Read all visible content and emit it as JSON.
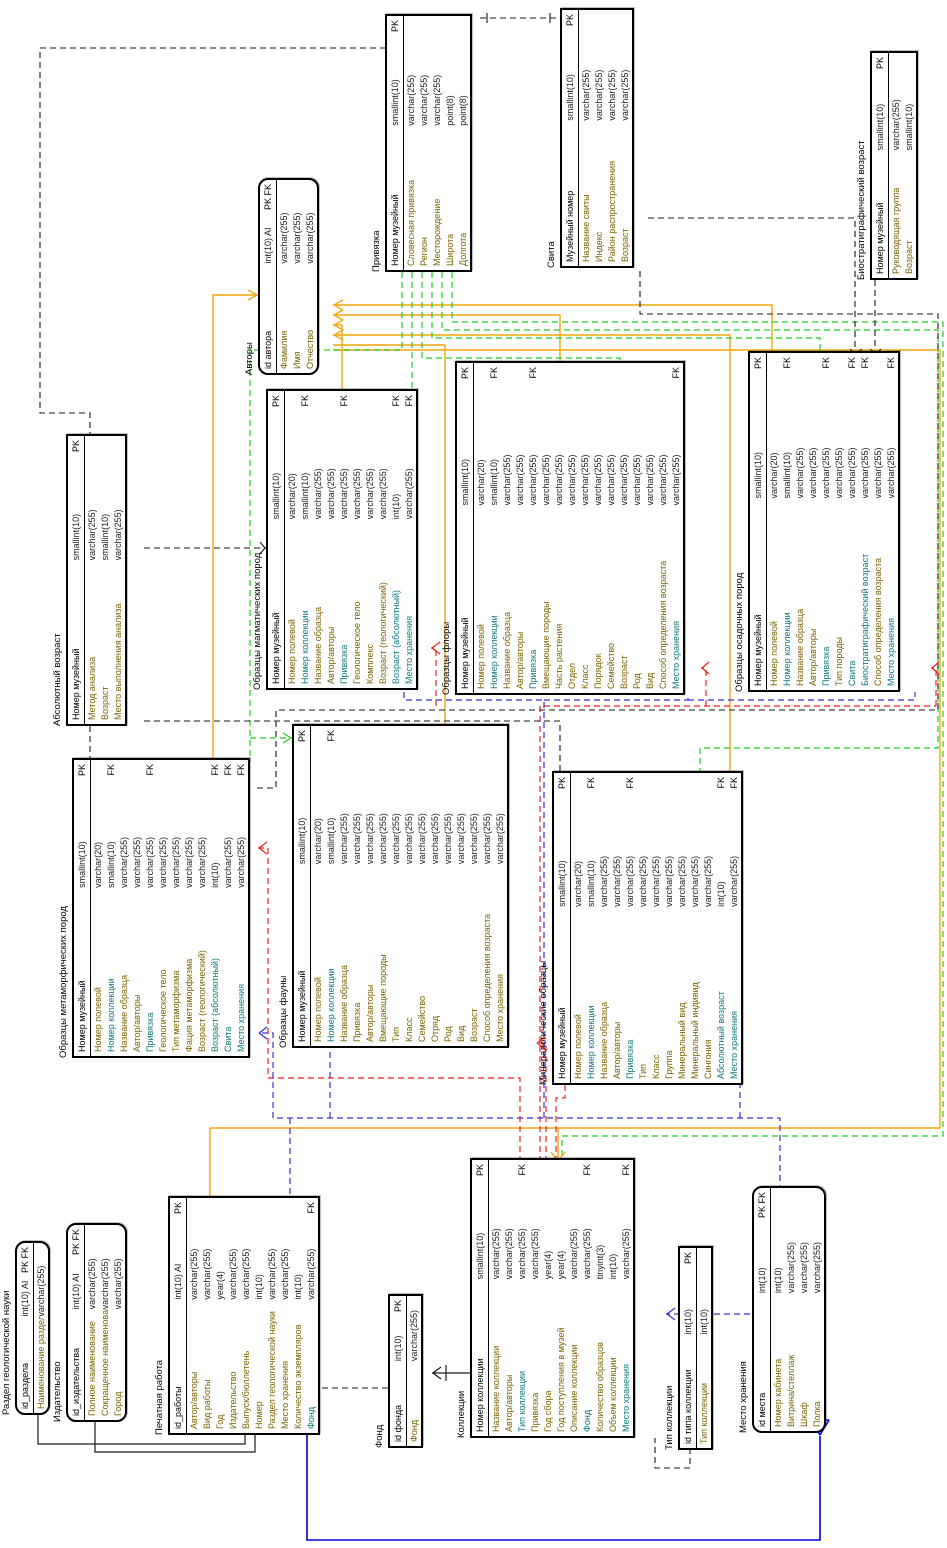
{
  "diagram": {
    "title": "EER-диаграмма геологического музея",
    "canvas": {
      "width": 1548,
      "height": 947,
      "rotation_deg": -90
    },
    "colors": {
      "authors_link": "#f2a70c",
      "privyazka_link": "#21cc21",
      "collection_link": "#ee2222",
      "storage_link_dashed": "#3333cc",
      "storage_link_solid": "#0000dd",
      "generic_link": "#1a1a1a",
      "fk_field_text": "#0e7878",
      "field_text": "#7a6400"
    },
    "tables": [
      {
        "id": "privyazka",
        "name": "Привязка",
        "x": 1276,
        "y": 385,
        "w": 254,
        "rounded": false,
        "fields": [
          {
            "n": "Номер музейный",
            "t": "smallint(10)",
            "k": "PK"
          },
          {
            "n": "Словесная привязка",
            "t": "varchar(255)",
            "k": ""
          },
          {
            "n": "Регион",
            "t": "varchar(255)",
            "k": ""
          },
          {
            "n": "Месторождение",
            "t": "varchar(255)",
            "k": ""
          },
          {
            "n": "Широта",
            "t": "point(8)",
            "k": ""
          },
          {
            "n": "Долгота",
            "t": "point(8)",
            "k": ""
          }
        ]
      },
      {
        "id": "svita",
        "name": "Свита",
        "x": 1280,
        "y": 560,
        "w": 256,
        "rounded": false,
        "fields": [
          {
            "n": "Музейный номер",
            "t": "smallint(10)",
            "k": "PK"
          },
          {
            "n": "Название свиты",
            "t": "varchar(255)",
            "k": ""
          },
          {
            "n": "Индекс",
            "t": "varchar(255)",
            "k": ""
          },
          {
            "n": "Район распространения",
            "t": "varchar(255)",
            "k": ""
          },
          {
            "n": "Возраст",
            "t": "varchar(255)",
            "k": ""
          }
        ]
      },
      {
        "id": "biostrat",
        "name": "Биостратиграфический возраст",
        "x": 1268,
        "y": 870,
        "w": 225,
        "rounded": false,
        "fields": [
          {
            "n": "Номер музейный",
            "t": "smallint(10)",
            "k": "PK"
          },
          {
            "n": "Руководящая группа",
            "t": "varchar(255)",
            "k": ""
          },
          {
            "n": "Возраст",
            "t": "smallint(10)",
            "k": ""
          }
        ]
      },
      {
        "id": "avtory",
        "name": "Авторы",
        "x": 1173,
        "y": 258,
        "w": 193,
        "rounded": true,
        "fields": [
          {
            "n": "id автора",
            "t": "int(10) AI",
            "k": "PK FK"
          },
          {
            "n": "Фамилия",
            "t": "varchar(255)",
            "k": ""
          },
          {
            "n": "Имя",
            "t": "varchar(255)",
            "k": ""
          },
          {
            "n": "Отчество",
            "t": "varchar(255)",
            "k": ""
          }
        ]
      },
      {
        "id": "abs_vozrast",
        "name": "Абсолютный возраст",
        "x": 822,
        "y": 66,
        "w": 288,
        "rounded": false,
        "fields": [
          {
            "n": "Номер музейный",
            "t": "smallint(10)",
            "k": "PK"
          },
          {
            "n": "Метод анализа",
            "t": "varchar(255)",
            "k": ""
          },
          {
            "n": "Возраст",
            "t": "smallint(10)",
            "k": ""
          },
          {
            "n": "Место выполнения анализа",
            "t": "varchar(255)",
            "k": ""
          }
        ]
      },
      {
        "id": "metamorf",
        "name": "Образцы метаморфических пород",
        "x": 490,
        "y": 72,
        "w": 296,
        "rounded": false,
        "fields": [
          {
            "n": "Номер музейный",
            "t": "smallint(10)",
            "k": "PK"
          },
          {
            "n": "Номер полевой",
            "t": "varchar(20)",
            "k": ""
          },
          {
            "n": "Номер коллекции",
            "t": "smallint(10)",
            "k": "FK"
          },
          {
            "n": "Название образца",
            "t": "varchar(255)",
            "k": ""
          },
          {
            "n": "Автор/авторы",
            "t": "varchar(255)",
            "k": ""
          },
          {
            "n": "Привязка",
            "t": "varchar(255)",
            "k": "FK"
          },
          {
            "n": "Геологическое тело",
            "t": "varchar(255)",
            "k": ""
          },
          {
            "n": "Тип метаморфизма",
            "t": "varchar(255)",
            "k": ""
          },
          {
            "n": "Фация метаморфизма",
            "t": "varchar(255)",
            "k": ""
          },
          {
            "n": "Возраст (геологический)",
            "t": "varchar(255)",
            "k": ""
          },
          {
            "n": "Возраст (абсолютный)",
            "t": "int(10)",
            "k": "FK"
          },
          {
            "n": "Свита",
            "t": "varchar(255)",
            "k": "FK"
          },
          {
            "n": "Место хранения",
            "t": "varchar(255)",
            "k": "FK"
          }
        ]
      },
      {
        "id": "magma",
        "name": "Образцы магматических пород",
        "x": 858,
        "y": 266,
        "w": 297,
        "rounded": false,
        "fields": [
          {
            "n": "Номер музейный",
            "t": "smallint(10)",
            "k": "PK"
          },
          {
            "n": "Номер полевой",
            "t": "varchar(20)",
            "k": ""
          },
          {
            "n": "Номер коллекции",
            "t": "smallint(10)",
            "k": "FK"
          },
          {
            "n": "Название образца",
            "t": "varchar(255)",
            "k": ""
          },
          {
            "n": "Автор/авторы",
            "t": "varchar(255)",
            "k": ""
          },
          {
            "n": "Привязка",
            "t": "varchar(255)",
            "k": "FK"
          },
          {
            "n": "Геологическое тело",
            "t": "varchar(255)",
            "k": ""
          },
          {
            "n": "Комплекс",
            "t": "varchar(255)",
            "k": ""
          },
          {
            "n": "Возраст (геологический)",
            "t": "varchar(255)",
            "k": ""
          },
          {
            "n": "Возраст (абсолютный)",
            "t": "int(10)",
            "k": "FK"
          },
          {
            "n": "Место хранения",
            "t": "varchar(255)",
            "k": "FK"
          }
        ]
      },
      {
        "id": "flora",
        "name": "Образцы флоры",
        "x": 853,
        "y": 455,
        "w": 330,
        "rounded": false,
        "fields": [
          {
            "n": "Номер музейный",
            "t": "smallint(10)",
            "k": "PK"
          },
          {
            "n": "Номер полевой",
            "t": "varchar(20)",
            "k": ""
          },
          {
            "n": "Номер коллекции",
            "t": "smallint(10)",
            "k": "FK"
          },
          {
            "n": "Название образца",
            "t": "varchar(255)",
            "k": ""
          },
          {
            "n": "Автор/авторы",
            "t": "varchar(255)",
            "k": ""
          },
          {
            "n": "Привязка",
            "t": "varchar(255)",
            "k": "FK"
          },
          {
            "n": "Вмещающие породы",
            "t": "varchar(255)",
            "k": ""
          },
          {
            "n": "Часть растения",
            "t": "varchar(255)",
            "k": ""
          },
          {
            "n": "Отдел",
            "t": "varchar(255)",
            "k": ""
          },
          {
            "n": "Класс",
            "t": "varchar(255)",
            "k": ""
          },
          {
            "n": "Порядок",
            "t": "varchar(255)",
            "k": ""
          },
          {
            "n": "Семейство",
            "t": "varchar(255)",
            "k": ""
          },
          {
            "n": "Возраст",
            "t": "varchar(255)",
            "k": ""
          },
          {
            "n": "Род",
            "t": "varchar(255)",
            "k": ""
          },
          {
            "n": "Вид",
            "t": "varchar(255)",
            "k": ""
          },
          {
            "n": "Способ определения возраста",
            "t": "varchar(255)",
            "k": ""
          },
          {
            "n": "Место хранения",
            "t": "varchar(255)",
            "k": "FK"
          }
        ]
      },
      {
        "id": "fauna",
        "name": "Образцы фауны",
        "x": 500,
        "y": 292,
        "w": 320,
        "rounded": false,
        "fields": [
          {
            "n": "Номер музейный",
            "t": "smallint(10)",
            "k": "PK"
          },
          {
            "n": "Номер полевой",
            "t": "varchar(20)",
            "k": ""
          },
          {
            "n": "Номер коллекции",
            "t": "smallint(10)",
            "k": "FK"
          },
          {
            "n": "Название образца",
            "t": "varchar(255)",
            "k": ""
          },
          {
            "n": "Привязка",
            "t": "varchar(255)",
            "k": ""
          },
          {
            "n": "Автор/авторы",
            "t": "varchar(255)",
            "k": ""
          },
          {
            "n": "Вмещающие породы",
            "t": "varchar(255)",
            "k": ""
          },
          {
            "n": "Тип",
            "t": "varchar(255)",
            "k": ""
          },
          {
            "n": "Класс",
            "t": "varchar(255)",
            "k": ""
          },
          {
            "n": "Семейство",
            "t": "varchar(255)",
            "k": ""
          },
          {
            "n": "Отряд",
            "t": "varchar(255)",
            "k": ""
          },
          {
            "n": "Род",
            "t": "varchar(255)",
            "k": ""
          },
          {
            "n": "Вид",
            "t": "varchar(255)",
            "k": ""
          },
          {
            "n": "Возраст",
            "t": "varchar(255)",
            "k": ""
          },
          {
            "n": "Способ определения возраста",
            "t": "varchar(255)",
            "k": ""
          },
          {
            "n": "Место хранения",
            "t": "varchar(255)",
            "k": ""
          }
        ]
      },
      {
        "id": "osad",
        "name": "Образцы осадочных пород",
        "x": 856,
        "y": 748,
        "w": 337,
        "rounded": false,
        "fields": [
          {
            "n": "Номер музейный",
            "t": "smallint(10)",
            "k": "PK"
          },
          {
            "n": "Номер полевой",
            "t": "varchar(20)",
            "k": ""
          },
          {
            "n": "Номер коллекции",
            "t": "smallint(10)",
            "k": "FK"
          },
          {
            "n": "Название образца",
            "t": "varchar(255)",
            "k": ""
          },
          {
            "n": "Автор/авторы",
            "t": "varchar(255)",
            "k": ""
          },
          {
            "n": "Привязка",
            "t": "varchar(255)",
            "k": "FK"
          },
          {
            "n": "Тип породы",
            "t": "varchar(255)",
            "k": ""
          },
          {
            "n": "Свита",
            "t": "varchar(255)",
            "k": "FK"
          },
          {
            "n": "Биостратиграфический возраст",
            "t": "varchar(255)",
            "k": "FK"
          },
          {
            "n": "Способ определения возраста",
            "t": "varchar(255)",
            "k": ""
          },
          {
            "n": "Место хранения",
            "t": "varchar(255)",
            "k": "FK"
          }
        ]
      },
      {
        "id": "minera",
        "name": "Минералогические образцы",
        "x": 463,
        "y": 552,
        "w": 310,
        "rounded": false,
        "fields": [
          {
            "n": "Номер музейный",
            "t": "smallint(10)",
            "k": "PK"
          },
          {
            "n": "Номер полевой",
            "t": "varchar(20)",
            "k": ""
          },
          {
            "n": "Номер коллекции",
            "t": "smallint(10)",
            "k": "FK"
          },
          {
            "n": "Название образца",
            "t": "varchar(255)",
            "k": ""
          },
          {
            "n": "Автор/авторы",
            "t": "varchar(255)",
            "k": ""
          },
          {
            "n": "Привязка",
            "t": "varchar(255)",
            "k": "FK"
          },
          {
            "n": "Тип",
            "t": "varchar(255)",
            "k": ""
          },
          {
            "n": "Класс",
            "t": "varchar(255)",
            "k": ""
          },
          {
            "n": "Группа",
            "t": "varchar(255)",
            "k": ""
          },
          {
            "n": "Минеральный вид",
            "t": "varchar(255)",
            "k": ""
          },
          {
            "n": "Минеральный индивид",
            "t": "varchar(255)",
            "k": ""
          },
          {
            "n": "Сингония",
            "t": "varchar(255)",
            "k": ""
          },
          {
            "n": "Абсолютный возраст",
            "t": "int(10)",
            "k": "FK"
          },
          {
            "n": "Место хранения",
            "t": "varchar(255)",
            "k": "FK"
          }
        ]
      },
      {
        "id": "razdel",
        "name": "Раздел геологической науки",
        "x": 133,
        "y": 15,
        "w": 170,
        "rounded": true,
        "fields": [
          {
            "n": "id_раздела",
            "t": "int(10) AI",
            "k": "PK FK"
          },
          {
            "n": "Наименование раздела",
            "t": "varchar(255)",
            "k": ""
          }
        ]
      },
      {
        "id": "izdat",
        "name": "Издательство",
        "x": 126,
        "y": 66,
        "w": 195,
        "rounded": true,
        "fields": [
          {
            "n": "id_издательства",
            "t": "int(10) AI",
            "k": "PK FK"
          },
          {
            "n": "Полное наименование",
            "t": "varchar(255)",
            "k": ""
          },
          {
            "n": "Сокращенное наименование",
            "t": "varchar(255)",
            "k": ""
          },
          {
            "n": "Город",
            "t": "varchar(255)",
            "k": ""
          }
        ]
      },
      {
        "id": "pechat",
        "name": "Печатная работа",
        "x": 113,
        "y": 168,
        "w": 235,
        "rounded": false,
        "fields": [
          {
            "n": "id_работы",
            "t": "int(10) AI",
            "k": "PK"
          },
          {
            "n": "Автор/авторы",
            "t": "varchar(255)",
            "k": ""
          },
          {
            "n": "Вид работы",
            "t": "varchar(255)",
            "k": ""
          },
          {
            "n": "Год",
            "t": "year(4)",
            "k": ""
          },
          {
            "n": "Издательство",
            "t": "varchar(255)",
            "k": ""
          },
          {
            "n": "Выпуск/бюллетень",
            "t": "varchar(255)",
            "k": ""
          },
          {
            "n": "Номер",
            "t": "int(10)",
            "k": ""
          },
          {
            "n": "Раздел геологической науки",
            "t": "varchar(255)",
            "k": ""
          },
          {
            "n": "Место хранения",
            "t": "varchar(255)",
            "k": ""
          },
          {
            "n": "Количество экземпляров",
            "t": "int(10)",
            "k": ""
          },
          {
            "n": "Фонд",
            "t": "varchar(255)",
            "k": "FK"
          }
        ]
      },
      {
        "id": "fond",
        "name": "Фонд",
        "x": 100,
        "y": 388,
        "w": 150,
        "rounded": false,
        "fields": [
          {
            "n": "id фонда",
            "t": "int(10)",
            "k": "PK"
          },
          {
            "n": "Фонд",
            "t": "varchar(255)",
            "k": ""
          }
        ]
      },
      {
        "id": "kollekcii",
        "name": "Коллекции",
        "x": 110,
        "y": 470,
        "w": 276,
        "rounded": false,
        "fields": [
          {
            "n": "Номер коллекции",
            "t": "smallint(10)",
            "k": "PK"
          },
          {
            "n": "Название коллекции",
            "t": "varchar(255)",
            "k": ""
          },
          {
            "n": "Автор/авторы",
            "t": "varchar(255)",
            "k": ""
          },
          {
            "n": "Тип коллекции",
            "t": "varchar(255)",
            "k": "FK"
          },
          {
            "n": "Привязка",
            "t": "varchar(255)",
            "k": ""
          },
          {
            "n": "Год сбора",
            "t": "year(4)",
            "k": ""
          },
          {
            "n": "Год поступления в музей",
            "t": "year(4)",
            "k": ""
          },
          {
            "n": "Описание коллекции",
            "t": "varchar(255)",
            "k": ""
          },
          {
            "n": "Фонд",
            "t": "varchar(255)",
            "k": "FK"
          },
          {
            "n": "Количество образцов",
            "t": "tinyint(3)",
            "k": ""
          },
          {
            "n": "Объем коллекции",
            "t": "int(10)",
            "k": ""
          },
          {
            "n": "Место хранения",
            "t": "varchar(255)",
            "k": "FK"
          }
        ]
      },
      {
        "id": "tip_kollekcii",
        "name": "Тип коллекции",
        "x": 98,
        "y": 678,
        "w": 200,
        "rounded": false,
        "fields": [
          {
            "n": "id типа коллекции",
            "t": "int(10)",
            "k": "PK"
          },
          {
            "n": "Тип коллекции",
            "t": "int(10)",
            "k": ""
          }
        ]
      },
      {
        "id": "mesto",
        "name": "Место хранения",
        "x": 115,
        "y": 752,
        "w": 243,
        "rounded": true,
        "fields": [
          {
            "n": "id места",
            "t": "int(10)",
            "k": "PK FK"
          },
          {
            "n": "Номер кабинета",
            "t": "int(10)",
            "k": ""
          },
          {
            "n": "Витрина/стеллаж",
            "t": "varchar(255)",
            "k": ""
          },
          {
            "n": "Шкаф",
            "t": "varchar(255)",
            "k": ""
          },
          {
            "n": "Полка",
            "t": "varchar(255)",
            "k": ""
          }
        ]
      }
    ]
  }
}
